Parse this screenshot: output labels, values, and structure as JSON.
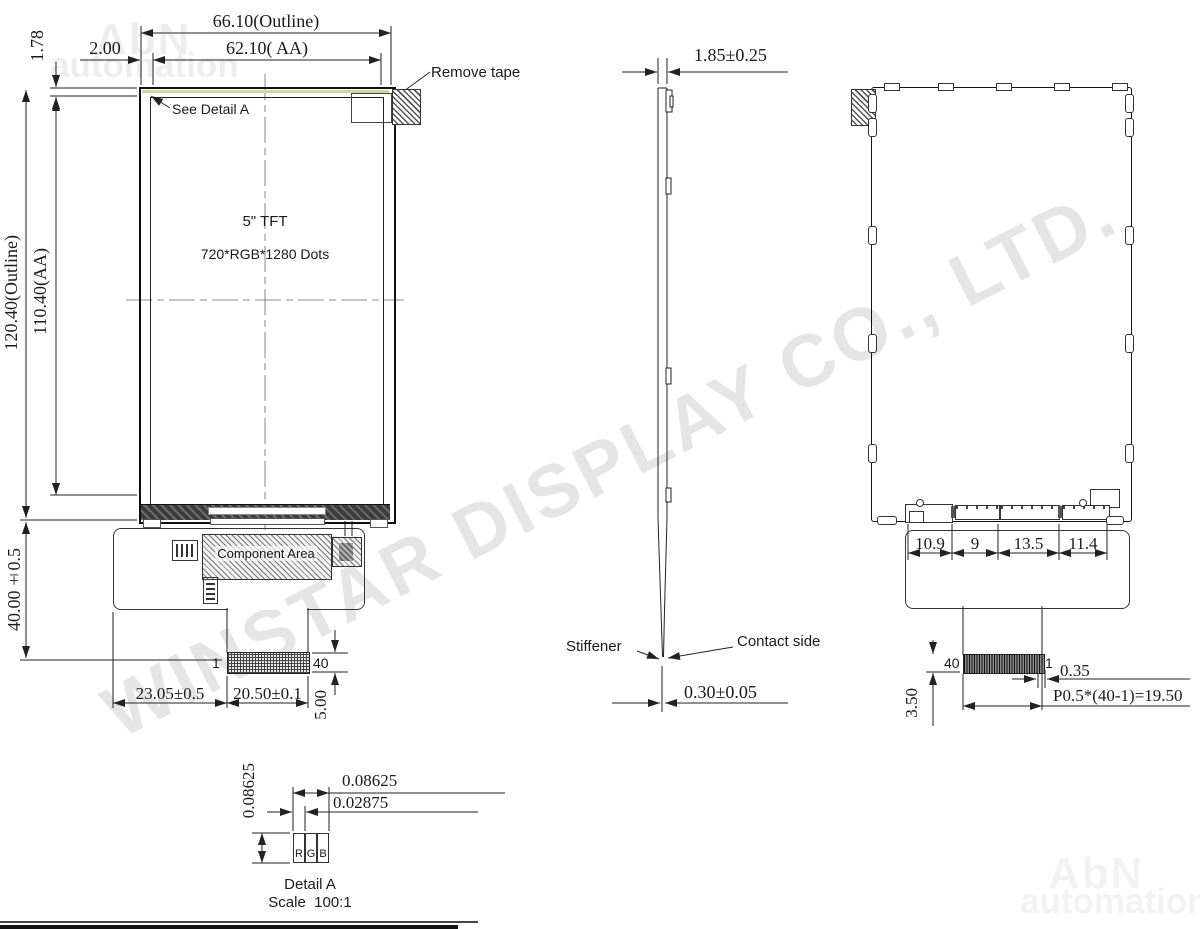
{
  "watermarks": {
    "corner_top": "AbN",
    "corner_bottom": "automation",
    "diagonal": "WINSTAR DISPLAY CO., LTD."
  },
  "front_view": {
    "label_size": "5\" TFT",
    "label_resolution": "720*RGB*1280 Dots",
    "label_see_detail": "See Detail A",
    "label_remove_tape": "Remove tape",
    "label_component_area": "Component Area",
    "pin_first": "1",
    "pin_last": "40",
    "dim_outline_width": "66.10(Outline)",
    "dim_aa_width": "62.10( AA)",
    "dim_left_border": "2.00",
    "dim_top_border": "1.78",
    "dim_outline_height": "120.40(Outline)",
    "dim_aa_height": "110.40(AA)",
    "dim_fpc_length": "40.00±0.5",
    "dim_connector_offset": "23.05±0.5",
    "dim_connector_width": "20.50±0.1",
    "dim_connector_length": "5.00"
  },
  "side_view": {
    "dim_thickness": "1.85±0.25",
    "label_stiffener": "Stiffener",
    "label_contact_side": "Contact side",
    "dim_fpc_thickness": "0.30±0.05"
  },
  "back_view": {
    "dim_seg_1": "10.9",
    "dim_seg_2": "9",
    "dim_seg_3": "13.5",
    "dim_seg_4": "11.4",
    "pin_last": "40",
    "pin_first": "1",
    "dim_pin_width": "0.35",
    "dim_pitch_formula": "P0.5*(40-1)=19.50",
    "dim_stiffener": "3.50"
  },
  "detail_a": {
    "dim_pixel_height": "0.08625",
    "dim_pixel_width": "0.08625",
    "dim_subpixel_width": "0.02875",
    "subpixel_r": "R",
    "subpixel_g": "G",
    "subpixel_b": "B",
    "title": "Detail A",
    "scale": "Scale  100:1"
  }
}
